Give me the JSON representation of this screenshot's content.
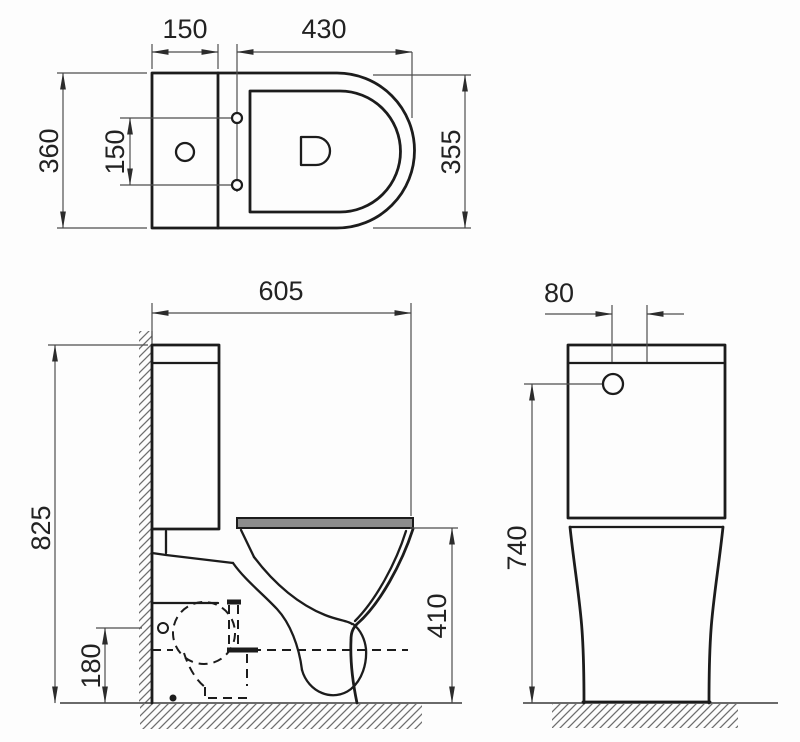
{
  "drawing": {
    "top_view": {
      "tank_width": "150",
      "seat_length": "430",
      "overall_depth": "360",
      "hinge_hole_spacing": "150",
      "bowl_depth": "355"
    },
    "side_view": {
      "overall_length": "605",
      "overall_height": "825",
      "fixing_height": "180",
      "rim_height": "410"
    },
    "front_view": {
      "button_offset": "80",
      "inlet_height": "740"
    }
  }
}
